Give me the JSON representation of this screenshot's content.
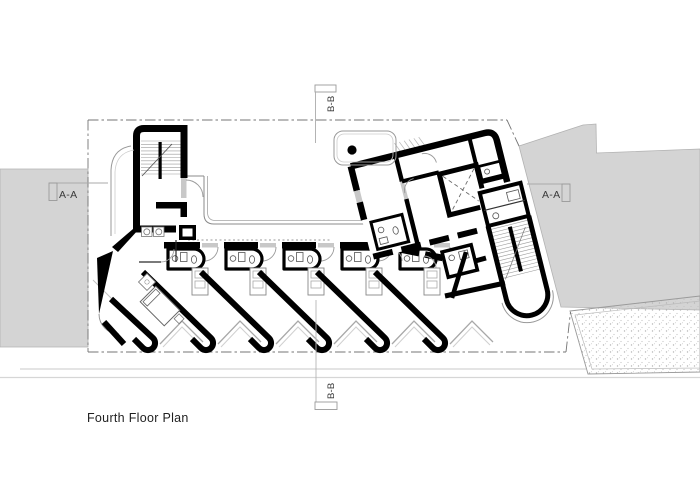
{
  "page": {
    "kind": "architectural-floor-plan-sheet",
    "background_color": "#ffffff",
    "width": 700,
    "height": 495
  },
  "drawing": {
    "title": "Fourth Floor Plan",
    "section_markers": {
      "aa_left": "A-A",
      "aa_right": "A-A",
      "bb_top": "B-B",
      "bb_bottom": "B-B"
    },
    "colors": {
      "wall_poche": "#000000",
      "site_fill": "#d4d4d4",
      "site_outline": "#b2b2b2",
      "thin_line": "#888888",
      "boundary_line": "#747474",
      "door_sill": "#c8c8c8",
      "label_text": "#3a3a3a"
    }
  }
}
